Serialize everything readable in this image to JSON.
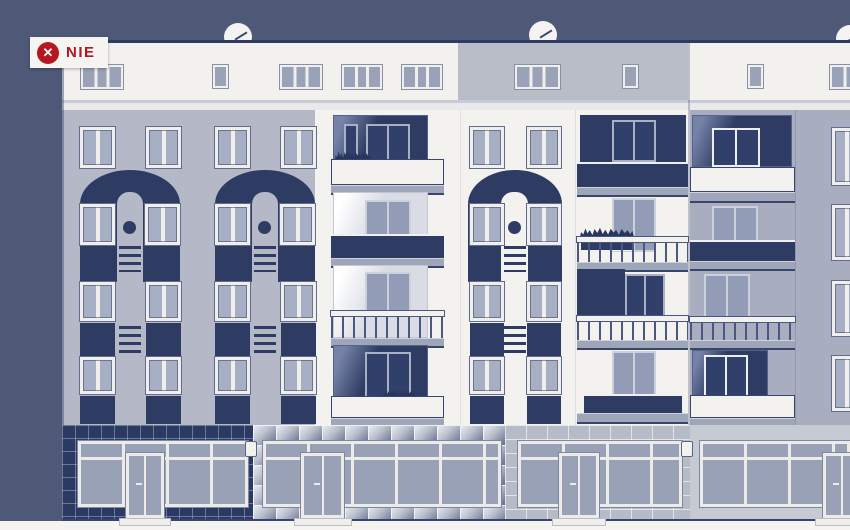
{
  "badge": {
    "label": "NIE",
    "icon_glyph": "✕"
  },
  "palette": {
    "background_navy": "#4e5977",
    "accent_navy": "#2e3c63",
    "negative_red": "#b5161f",
    "facade_light_gray": "#b5b9c7",
    "facade_white": "#f3f2ef",
    "facade_gray": "#a8aec0",
    "attic_gray": "#b9bdc8",
    "window_glass": "#9aa2b8",
    "shop_wall_navy": "#2a3a63",
    "ground_white": "#f5f4f1"
  }
}
